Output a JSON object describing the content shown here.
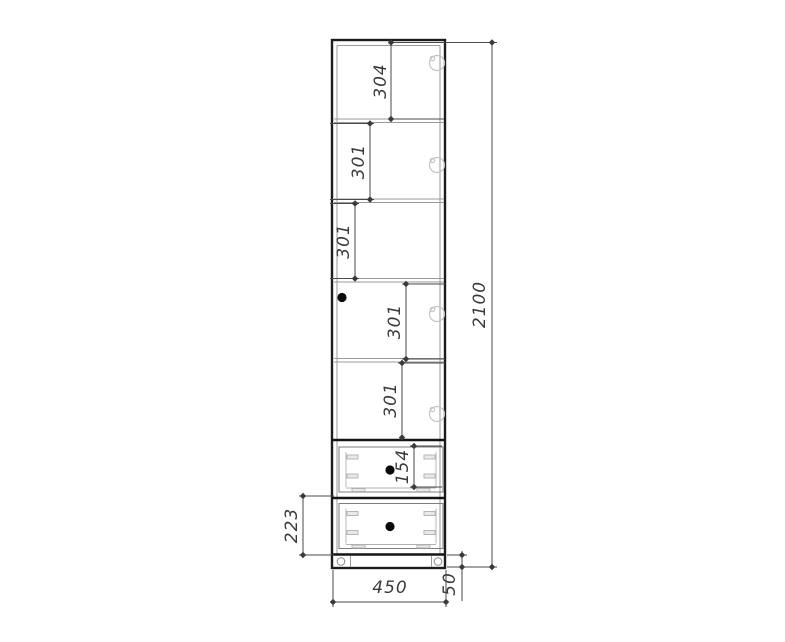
{
  "drawing": {
    "dimensions": {
      "compartment_1_height": "304",
      "compartment_2_height": "301",
      "compartment_3_height": "301",
      "compartment_4_height": "301",
      "compartment_5_height": "301",
      "drawer_1_front_height": "154",
      "drawer_2_height": "223",
      "overall_height": "2100",
      "overall_width": "450",
      "plinth_height": "50"
    },
    "colors": {
      "outline_ink": "#1c1c1c",
      "dimension_ink": "#4a4a4a",
      "light_ink": "#9a9a9a",
      "background": "#ffffff"
    }
  }
}
